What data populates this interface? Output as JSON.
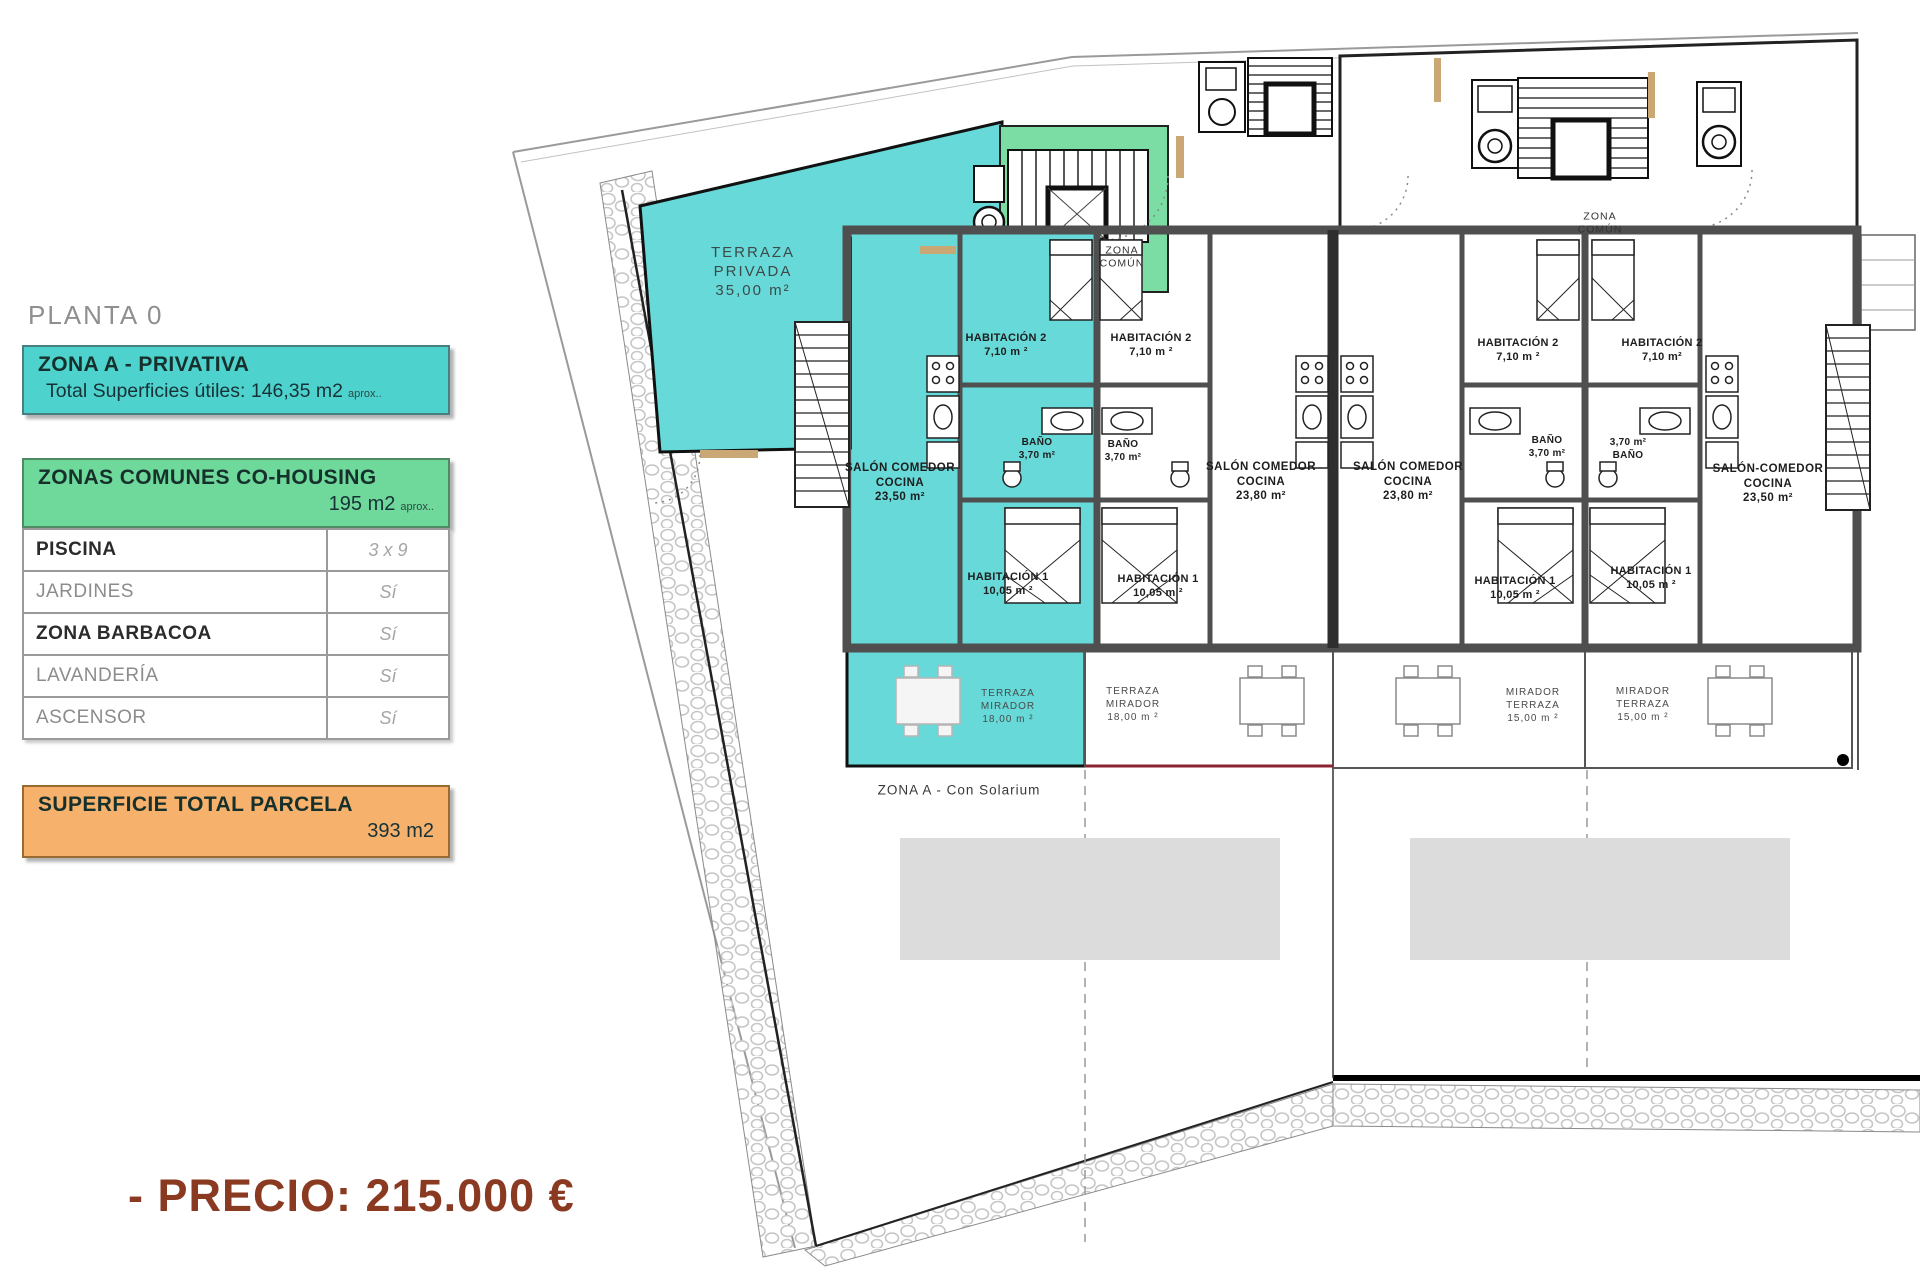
{
  "header": {
    "floor_label": "PLANTA 0"
  },
  "price_line": "- PRECIO: 215.000 €",
  "colors": {
    "accent_cyan": "#4ed2cd",
    "accent_green": "#6fd89b",
    "accent_orange": "#f6b26d",
    "price_brown": "#8b3a22",
    "plan_cyan": "#67d9d8",
    "plan_green": "#7bdca4",
    "wall_gray": "#4f4f4f"
  },
  "panels": {
    "zona_a": {
      "title": "ZONA A - PRIVATIVA",
      "total_label": "Total Superficies útiles: 146,35 m2",
      "approx": "aprox.."
    },
    "zonas_comunes": {
      "title": "ZONAS COMUNES CO-HOUSING",
      "area": "195 m2",
      "approx": "aprox.."
    },
    "amenities": {
      "rows": [
        {
          "label": "PISCINA",
          "value": "3 x 9",
          "emphasis": true
        },
        {
          "label": "JARDINES",
          "value": "Sí",
          "emphasis": false
        },
        {
          "label": "ZONA BARBACOA",
          "value": "Sí",
          "emphasis": true
        },
        {
          "label": "LAVANDERÍA",
          "value": "Sí",
          "emphasis": false
        },
        {
          "label": "ASCENSOR",
          "value": "Sí",
          "emphasis": false
        }
      ]
    },
    "superficie_total": {
      "title": "SUPERFICIE TOTAL PARCELA",
      "area": "393 m2"
    }
  },
  "plan": {
    "labels": [
      {
        "x": 753,
        "y": 272,
        "size": 15,
        "bold": false,
        "ls": 2,
        "color": "#3d4a4a",
        "lines": [
          "TERRAZA",
          "PRIVADA",
          "35,00 m²"
        ]
      },
      {
        "x": 1122,
        "y": 258,
        "size": 10.5,
        "bold": false,
        "ls": 1,
        "color": "#333333",
        "lines": [
          "ZONA",
          "COMÚN"
        ]
      },
      {
        "x": 1600,
        "y": 224,
        "size": 10.5,
        "bold": false,
        "ls": 1,
        "color": "#333333",
        "lines": [
          "ZONA",
          "COMÚN"
        ]
      },
      {
        "x": 900,
        "y": 483,
        "size": 11.5,
        "bold": true,
        "ls": 0.5,
        "color": "#1d1d1d",
        "lines": [
          "SALÓN COMEDOR",
          "COCINA",
          "23,50 m²"
        ]
      },
      {
        "x": 1006,
        "y": 345,
        "size": 11,
        "bold": true,
        "ls": 0.3,
        "color": "#1d1d1d",
        "lines": [
          "HABITACIÓN 2",
          "7,10 m ²"
        ]
      },
      {
        "x": 1037,
        "y": 450,
        "size": 10,
        "bold": true,
        "ls": 0.3,
        "color": "#1d1d1d",
        "lines": [
          "BAÑO",
          "3,70 m²"
        ]
      },
      {
        "x": 1008,
        "y": 584,
        "size": 11,
        "bold": true,
        "ls": 0.3,
        "color": "#1d1d1d",
        "lines": [
          "HABITACIÓN 1",
          "10,05 m ²"
        ]
      },
      {
        "x": 1151,
        "y": 345,
        "size": 11,
        "bold": true,
        "ls": 0.3,
        "color": "#1d1d1d",
        "lines": [
          "HABITACIÓN 2",
          "7,10 m ²"
        ]
      },
      {
        "x": 1123,
        "y": 452,
        "size": 10,
        "bold": true,
        "ls": 0.3,
        "color": "#1d1d1d",
        "lines": [
          "BAÑO",
          "3,70 m²"
        ]
      },
      {
        "x": 1261,
        "y": 482,
        "size": 11.5,
        "bold": true,
        "ls": 0.5,
        "color": "#1d1d1d",
        "lines": [
          "SALÓN COMEDOR",
          "COCINA",
          "23,80 m²"
        ]
      },
      {
        "x": 1158,
        "y": 586,
        "size": 11,
        "bold": true,
        "ls": 0.3,
        "color": "#1d1d1d",
        "lines": [
          "HABITACIÓN 1",
          "10,05 m ²"
        ]
      },
      {
        "x": 1408,
        "y": 482,
        "size": 11.5,
        "bold": true,
        "ls": 0.5,
        "color": "#1d1d1d",
        "lines": [
          "SALÓN COMEDOR",
          "COCINA",
          "23,80 m²"
        ]
      },
      {
        "x": 1518,
        "y": 350,
        "size": 11,
        "bold": true,
        "ls": 0.3,
        "color": "#1d1d1d",
        "lines": [
          "HABITACIÓN 2",
          "7,10 m ²"
        ]
      },
      {
        "x": 1547,
        "y": 448,
        "size": 10,
        "bold": true,
        "ls": 0.3,
        "color": "#1d1d1d",
        "lines": [
          "BAÑO",
          "3,70 m²"
        ]
      },
      {
        "x": 1515,
        "y": 588,
        "size": 11,
        "bold": true,
        "ls": 0.3,
        "color": "#1d1d1d",
        "lines": [
          "HABITACIÓN 1",
          "10,05 m ²"
        ]
      },
      {
        "x": 1662,
        "y": 350,
        "size": 11,
        "bold": true,
        "ls": 0.3,
        "color": "#1d1d1d",
        "lines": [
          "HABITACIÓN 2",
          "7,10 m²"
        ]
      },
      {
        "x": 1628,
        "y": 450,
        "size": 10,
        "bold": true,
        "ls": 0.3,
        "color": "#1d1d1d",
        "lines": [
          "3,70 m²",
          "BAÑO"
        ]
      },
      {
        "x": 1651,
        "y": 578,
        "size": 11,
        "bold": true,
        "ls": 0.3,
        "color": "#1d1d1d",
        "lines": [
          "HABITACIÓN 1",
          "10,05 m ²"
        ]
      },
      {
        "x": 1768,
        "y": 484,
        "size": 11.5,
        "bold": true,
        "ls": 0.5,
        "color": "#1d1d1d",
        "lines": [
          "SALÓN-COMEDOR",
          "COCINA",
          "23,50 m²"
        ]
      },
      {
        "x": 1008,
        "y": 707,
        "size": 10,
        "bold": false,
        "ls": 1,
        "color": "#4a4a4a",
        "lines": [
          "TERRAZA",
          "MIRADOR",
          "18,00 m ²"
        ]
      },
      {
        "x": 1133,
        "y": 705,
        "size": 10,
        "bold": false,
        "ls": 1,
        "color": "#4a4a4a",
        "lines": [
          "TERRAZA",
          "MIRADOR",
          "18,00 m ²"
        ]
      },
      {
        "x": 1533,
        "y": 706,
        "size": 10,
        "bold": false,
        "ls": 1,
        "color": "#4a4a4a",
        "lines": [
          "MIRADOR",
          "TERRAZA",
          "15,00 m ²"
        ]
      },
      {
        "x": 1643,
        "y": 705,
        "size": 10,
        "bold": false,
        "ls": 1,
        "color": "#4a4a4a",
        "lines": [
          "MIRADOR",
          "TERRAZA",
          "15,00 m ²"
        ]
      },
      {
        "x": 959,
        "y": 790,
        "size": 13.5,
        "bold": false,
        "ls": 1,
        "color": "#3a3a3a",
        "lines": [
          "ZONA A - Con Solarium"
        ]
      }
    ]
  }
}
